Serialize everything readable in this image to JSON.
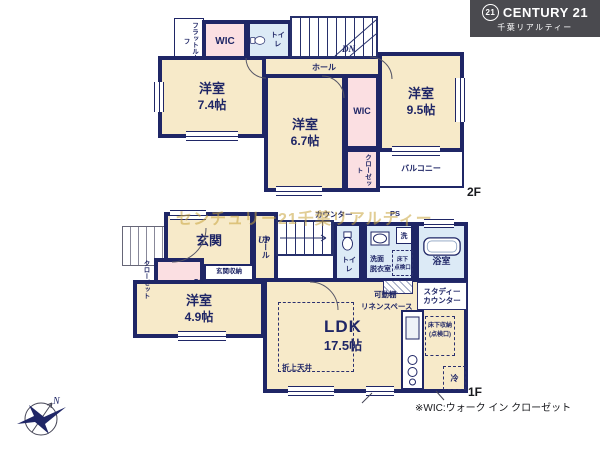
{
  "logo": {
    "mark": "21",
    "brand": "CENTURY 21",
    "company": "千葉リアルティー"
  },
  "watermark": "センチュリー21千葉リアルティー",
  "f2": {
    "floor_label": "2F",
    "flat_roof": "フラットルーフ",
    "wic_top": "WIC",
    "toilet": "トイレ",
    "stairs_dn": "DN",
    "hall": "ホール",
    "room74_name": "洋室",
    "room74_size": "7.4帖",
    "room67_name": "洋室",
    "room67_size": "6.7帖",
    "room95_name": "洋室",
    "room95_size": "9.5帖",
    "wic_mid": "WIC",
    "closet": "クローゼット",
    "balcony": "バルコニー"
  },
  "f1": {
    "floor_label": "1F",
    "entrance": "玄関",
    "entrance_storage": "玄関収納",
    "hall": "ホール",
    "stairs_up": "UP",
    "counter": "カウンター",
    "ps": "PS",
    "toilet": "トイレ",
    "washroom1": "洗面",
    "washroom2": "脱衣室",
    "washer": "洗",
    "hatch1a": "床下",
    "hatch1b": "点検口",
    "bath": "浴室",
    "closet": "クローゼット",
    "ds": "DS",
    "room49_name": "洋室",
    "room49_size": "4.9帖",
    "ldk_name": "LDK",
    "ldk_size": "17.5帖",
    "coffered": "折上天井",
    "movable_shelf": "可動棚",
    "linen": "リネンスペース",
    "study1": "スタディー",
    "study2": "カウンター",
    "storage1": "床下収納",
    "storage2": "(点検口)",
    "fridge": "冷"
  },
  "compass": {
    "north": "N"
  },
  "footnote": "※WIC:ウォーク イン クローゼット",
  "colors": {
    "wall": "#1f2666",
    "room": "#f7eac9",
    "closet": "#fbdfe2",
    "wet": "#dceaf6",
    "watermark": "#c9a53e",
    "logo_bg": "#4a4a4f"
  }
}
